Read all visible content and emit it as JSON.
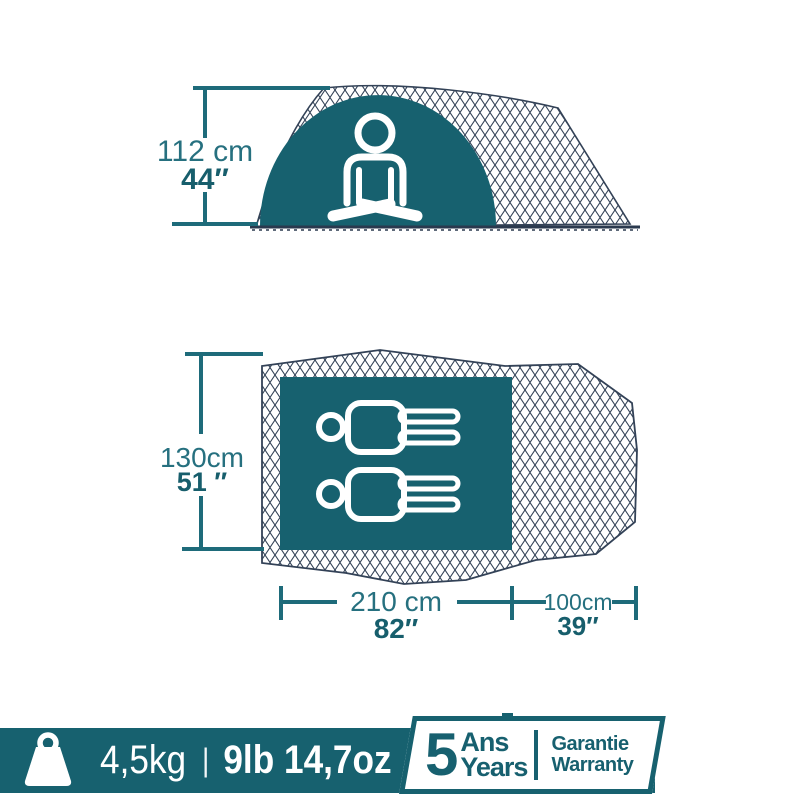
{
  "colors": {
    "teal_fill": "#17616F",
    "teal_dimension_line": "#1E6B7A",
    "metric_text": "#26707F",
    "imperial_text": "#175E6C",
    "mesh_line": "#334257",
    "background": "#FFFFFF"
  },
  "icons": {
    "side_figure": "seated-person-icon",
    "floor_figure": "two-lying-persons-icon",
    "footer_weight": "weight-icon"
  },
  "side_view": {
    "height_metric": "112 cm",
    "height_imperial": "44″"
  },
  "floor_plan": {
    "width_metric": "130cm",
    "width_imperial": "51 ″",
    "bedroom_length_metric": "210 cm",
    "bedroom_length_imperial": "82″",
    "porch_length_metric": "100cm",
    "porch_length_imperial": "39″"
  },
  "footer": {
    "weight_metric": "4,5kg",
    "separator": "|",
    "weight_imperial": "9lb 14,7oz",
    "warranty_number": "5",
    "warranty_unit_fr": "Ans",
    "warranty_unit_en": "Years",
    "warranty_word_fr": "Garantie",
    "warranty_word_en": "Warranty"
  }
}
